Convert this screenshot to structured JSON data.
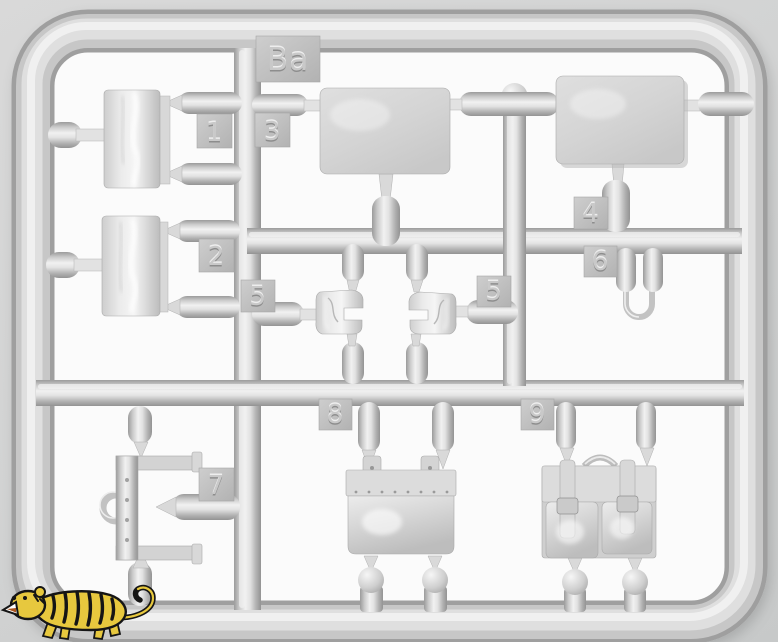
{
  "photo": {
    "subject": "gray plastic model kit sprue",
    "sprue_letter_tab": "Ba"
  },
  "sprue": {
    "frame_label": "Ba",
    "part_tags": [
      {
        "label": "1"
      },
      {
        "label": "2"
      },
      {
        "label": "3"
      },
      {
        "label": "4"
      },
      {
        "label": "5"
      },
      {
        "label": "5"
      },
      {
        "label": "6"
      },
      {
        "label": "7"
      },
      {
        "label": "8"
      },
      {
        "label": "9"
      }
    ]
  },
  "watermark": {
    "icon": "tiger-logo"
  },
  "colors": {
    "background": "#d2d3d3",
    "cell_background": "#fbfbfb",
    "plastic_base": "#c6c6c6",
    "plastic_shadow": "#9a9a9a",
    "plastic_highlight": "#f3f3f3",
    "tiger_yellow": "#e7c83e",
    "tiger_outline": "#151515"
  }
}
